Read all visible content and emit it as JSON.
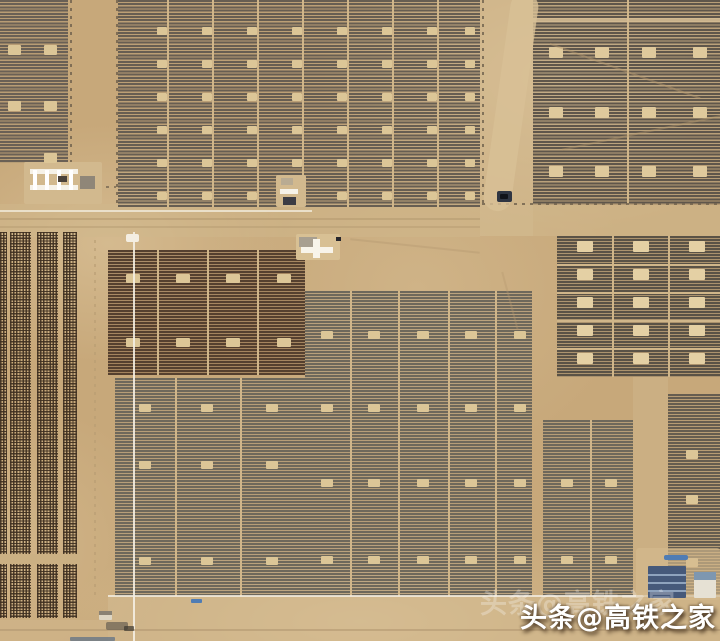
{
  "watermark": {
    "text": "头条@高铁之家"
  },
  "palette": {
    "sand_base": "#c7a87a",
    "sand_light": "#d8c198",
    "sand_road": "#d0b78c",
    "panel_gray": "#675e52",
    "panel_dark_brown": "#55402f",
    "panel_gray_olive": "#6e685b",
    "panel_cellgrid": "#5a5246",
    "marker_beige": "#dcc697",
    "marker_bright": "#e4d0a4",
    "white_line": "#f4eee2",
    "blue_roof": "#7e97b0",
    "blue_vehicle": "#4f7cb4",
    "dark_vehicle": "#2f3542"
  },
  "scene": {
    "divider_color": "#d0b68a",
    "marker_color": "#dcc697",
    "patches": [
      {
        "name": "road-band-sand",
        "x": 0,
        "y": 204,
        "w": 480,
        "h": 33,
        "color": "#d0b78c",
        "opacity": 0.5
      },
      {
        "name": "roadside-sand",
        "x": 480,
        "y": 0,
        "w": 53,
        "h": 236,
        "color": "#d3bb91",
        "opacity": 0.5
      },
      {
        "name": "road-band-right-sand",
        "x": 480,
        "y": 205,
        "w": 240,
        "h": 31,
        "color": "#d2b98e",
        "opacity": 0.5
      },
      {
        "name": "bottom-sand-band",
        "x": 108,
        "y": 597,
        "w": 612,
        "h": 44,
        "color": "#d4bb92",
        "opacity": 0.55
      },
      {
        "name": "bottom-left-sand",
        "x": 0,
        "y": 620,
        "w": 108,
        "h": 21,
        "color": "#d2b88e",
        "opacity": 0.5
      },
      {
        "name": "right-corridor-sand",
        "x": 633,
        "y": 377,
        "w": 35,
        "h": 220,
        "color": "#cfb68c",
        "opacity": 0.5
      }
    ],
    "blocks": [
      {
        "name": "pv-array-top-left",
        "kind": "hstripe",
        "x": 0,
        "y": 0,
        "w": 68,
        "h": 163,
        "dark": "#6a6055",
        "t": 2,
        "pitch": 3.2,
        "tint": "rgba(118,106,90,0.18)",
        "marker": {
          "cols": [
            8,
            44
          ],
          "rows": [
            45,
            101
          ],
          "w": 13,
          "h": 10
        }
      },
      {
        "name": "pv-array-top-middle",
        "kind": "hstripe",
        "x": 118,
        "y": 0,
        "w": 362,
        "h": 207,
        "dark": "#675e52",
        "t": 2,
        "pitch": 3.2,
        "tint": "rgba(120,108,92,0.15)",
        "dividers_v": [
          167,
          212,
          257,
          302,
          347,
          392,
          437
        ],
        "marker": {
          "cols": [
            157,
            202,
            247,
            292,
            337,
            382,
            427,
            465
          ],
          "rows": [
            27,
            60,
            93,
            126,
            159,
            192
          ],
          "w": 10,
          "h": 8
        }
      },
      {
        "name": "pv-array-top-right",
        "kind": "hstripe",
        "x": 533,
        "y": 0,
        "w": 187,
        "h": 205,
        "dark": "#5f564b",
        "t": 2,
        "pitch": 3.2,
        "tint": "rgba(110,98,84,0.2)",
        "dividers_v": [
          627
        ],
        "marker": {
          "cols": [
            549,
            595,
            642,
            693
          ],
          "rows": [
            47,
            107,
            166
          ],
          "w": 14,
          "h": 11,
          "color": "#dfc99c"
        }
      },
      {
        "name": "pv-array-dark-brown",
        "kind": "hstripe",
        "x": 108,
        "y": 250,
        "w": 197,
        "h": 125,
        "dark": "#55402f",
        "t": 2,
        "pitch": 3,
        "tint": "rgba(96,62,40,0.35)",
        "dividers_v": [
          157,
          207,
          257
        ],
        "marker": {
          "cols": [
            126,
            176,
            226,
            277
          ],
          "rows": [
            274,
            338
          ],
          "w": 14,
          "h": 9
        }
      },
      {
        "name": "pv-array-gray-left",
        "kind": "hstripe",
        "x": 115,
        "y": 378,
        "w": 190,
        "h": 218,
        "dark": "#6e685b",
        "t": 1.8,
        "pitch": 3,
        "tint": "rgba(130,124,110,0.25)",
        "dividers_v": [
          175,
          240
        ],
        "marker": {
          "cols": [
            139,
            201,
            266
          ],
          "rows": [
            404,
            461,
            557
          ],
          "w": 12,
          "h": 8
        }
      },
      {
        "name": "pv-array-gray-main",
        "kind": "hstripe",
        "x": 305,
        "y": 291,
        "w": 227,
        "h": 305,
        "dark": "#6e685b",
        "t": 1.8,
        "pitch": 3,
        "tint": "rgba(130,124,110,0.25)",
        "dividers_v": [
          350,
          398,
          448,
          495
        ],
        "marker": {
          "cols": [
            321,
            368,
            417,
            465,
            514
          ],
          "rows": [
            331,
            404,
            479,
            556
          ],
          "w": 12,
          "h": 8
        }
      },
      {
        "name": "pv-array-gray-right",
        "kind": "hstripe",
        "x": 543,
        "y": 420,
        "w": 90,
        "h": 176,
        "dark": "#6e685b",
        "t": 1.8,
        "pitch": 3,
        "tint": "rgba(130,124,110,0.25)",
        "dividers_v": [
          590
        ],
        "marker": {
          "cols": [
            561,
            605
          ],
          "rows": [
            479,
            556
          ],
          "w": 12,
          "h": 8
        }
      },
      {
        "name": "pv-array-cell-grid",
        "kind": "hstripe",
        "x": 557,
        "y": 236,
        "w": 163,
        "h": 141,
        "dark": "#5a5246",
        "t": 2,
        "pitch": 3,
        "tint": "rgba(105,95,80,0.3)",
        "dividers_v": [
          612,
          668
        ],
        "dividers_h": [
          264,
          292,
          320,
          348
        ],
        "marker": {
          "cols": [
            577,
            633,
            689
          ],
          "rows": [
            241,
            269,
            297,
            325,
            353
          ],
          "w": 16,
          "h": 11,
          "color": "#e4d0a4"
        }
      },
      {
        "name": "pv-array-bottom-right",
        "kind": "hstripe",
        "x": 668,
        "y": 394,
        "w": 52,
        "h": 203,
        "dark": "#665d50",
        "t": 2,
        "pitch": 3,
        "tint": "rgba(120,110,95,0.2)",
        "marker": {
          "cols": [
            686
          ],
          "rows": [
            450,
            495,
            558
          ],
          "w": 12,
          "h": 9
        }
      },
      {
        "name": "tracker-dot-strip",
        "kind": "dots",
        "x": 0,
        "y": 232,
        "w": 7,
        "h": 386,
        "dark": "rgba(62,47,32,0.9)"
      },
      {
        "name": "tracker-dot-strip",
        "kind": "dots",
        "x": 10,
        "y": 232,
        "w": 21,
        "h": 386,
        "dark": "rgba(62,47,32,0.9)"
      },
      {
        "name": "tracker-dot-strip",
        "kind": "dots",
        "x": 37,
        "y": 232,
        "w": 21,
        "h": 386,
        "dark": "rgba(62,47,32,0.9)"
      },
      {
        "name": "tracker-dot-strip",
        "kind": "dots",
        "x": 63,
        "y": 232,
        "w": 14,
        "h": 386,
        "dark": "rgba(62,47,32,0.9)"
      }
    ],
    "lines": [
      {
        "name": "fence-line",
        "kind": "dash-v",
        "x": 70,
        "y": 0,
        "w": 1.5,
        "h": 163,
        "color": "#6e604c",
        "opacity": 0.8
      },
      {
        "name": "fence-line",
        "kind": "dash-v",
        "x": 116,
        "y": 0,
        "w": 1.5,
        "h": 206,
        "color": "#6e604c",
        "opacity": 0.8
      },
      {
        "name": "fence-line",
        "kind": "dash-v",
        "x": 482,
        "y": 0,
        "w": 1.5,
        "h": 204,
        "color": "#6e604c",
        "opacity": 0.8
      },
      {
        "name": "fence-line",
        "kind": "dash-h",
        "x": 482,
        "y": 203,
        "w": 238,
        "h": 1.5,
        "color": "#6e604c",
        "opacity": 0.8
      },
      {
        "name": "fence-line",
        "kind": "dash-h",
        "x": 58,
        "y": 186,
        "w": 58,
        "h": 1.5,
        "color": "#6e604c",
        "opacity": 0.7
      },
      {
        "name": "road-white-line",
        "kind": "solid",
        "x": 0,
        "y": 210,
        "w": 312,
        "h": 2,
        "color": "#efe7d6",
        "opacity": 0.85
      },
      {
        "name": "tire-track",
        "kind": "solid",
        "x": 0,
        "y": 218,
        "w": 480,
        "h": 1.5,
        "color": "#b59b72",
        "opacity": 0.6
      },
      {
        "name": "tire-track",
        "kind": "solid",
        "x": 0,
        "y": 226,
        "w": 480,
        "h": 1.5,
        "color": "#b59b72",
        "opacity": 0.5
      },
      {
        "name": "utility-line",
        "kind": "solid",
        "x": 133,
        "y": 232,
        "w": 2,
        "h": 409,
        "color": "#f4eee2",
        "opacity": 0.9
      },
      {
        "name": "panel-edge-white-line",
        "kind": "solid",
        "x": 108,
        "y": 595,
        "w": 612,
        "h": 2,
        "color": "#f2ecdf",
        "opacity": 0.85
      },
      {
        "name": "bottom-road-line",
        "kind": "solid",
        "x": 0,
        "y": 629,
        "w": 720,
        "h": 2,
        "color": "#b39872",
        "opacity": 0.6
      },
      {
        "name": "panel-gap-line",
        "kind": "solid",
        "x": 533,
        "y": 18,
        "w": 187,
        "h": 4,
        "color": "#d5bd93",
        "opacity": 0.9
      },
      {
        "name": "corridor-track",
        "kind": "dash-v",
        "x": 94,
        "y": 240,
        "w": 1.5,
        "h": 360,
        "color": "#b79c72",
        "opacity": 0.6
      },
      {
        "name": "dot-array-gap",
        "kind": "solid",
        "x": 0,
        "y": 554,
        "w": 80,
        "h": 10,
        "color": "#cbb083",
        "opacity": 1
      }
    ],
    "structures": [
      {
        "name": "dirt-track-winding",
        "x": 497,
        "y": -8,
        "w": 28,
        "h": 220,
        "color": "#d8c096",
        "r": 14,
        "opacity": 0.8,
        "rotate": 8
      },
      {
        "name": "sand-crack",
        "x": 545,
        "y": 70,
        "w": 160,
        "h": 2,
        "color": "#b69a6e",
        "opacity": 0.45,
        "rotate": 20
      },
      {
        "name": "sand-crack",
        "x": 560,
        "y": 130,
        "w": 180,
        "h": 2,
        "color": "#b69a6e",
        "opacity": 0.4,
        "rotate": -12
      },
      {
        "name": "sand-crack",
        "x": 350,
        "y": 245,
        "w": 130,
        "h": 2,
        "color": "#b49870",
        "opacity": 0.4,
        "rotate": 6
      },
      {
        "name": "sand-crack",
        "x": 480,
        "y": 300,
        "w": 60,
        "h": 2,
        "color": "#b49870",
        "opacity": 0.35,
        "rotate": 75
      },
      {
        "name": "substation-pad",
        "x": 24,
        "y": 162,
        "w": 78,
        "h": 42,
        "color": "#d2b98e",
        "r": 2
      },
      {
        "name": "substation-gantry-bar",
        "x": 30,
        "y": 169,
        "w": 48,
        "h": 5,
        "color": "#f6f2e8"
      },
      {
        "name": "substation-gantry-bar",
        "x": 30,
        "y": 185,
        "w": 48,
        "h": 5,
        "color": "#f6f2e8"
      },
      {
        "name": "substation-post",
        "x": 33,
        "y": 170,
        "w": 4,
        "h": 20,
        "color": "#ffffff"
      },
      {
        "name": "substation-post",
        "x": 45,
        "y": 170,
        "w": 4,
        "h": 20,
        "color": "#ffffff"
      },
      {
        "name": "substation-post",
        "x": 57,
        "y": 170,
        "w": 4,
        "h": 20,
        "color": "#ffffff"
      },
      {
        "name": "substation-post",
        "x": 69,
        "y": 170,
        "w": 4,
        "h": 20,
        "color": "#ffffff"
      },
      {
        "name": "substation-box",
        "x": 80,
        "y": 176,
        "w": 15,
        "h": 13,
        "color": "#8f8678"
      },
      {
        "name": "substation-dark-unit",
        "x": 58,
        "y": 176,
        "w": 9,
        "h": 6,
        "color": "#4a423a"
      },
      {
        "name": "inverter-station-pad",
        "x": 276,
        "y": 175,
        "w": 30,
        "h": 32,
        "color": "#d2b98e",
        "r": 2
      },
      {
        "name": "inverter-station-box",
        "x": 281,
        "y": 178,
        "w": 12,
        "h": 7,
        "color": "#b9ab92"
      },
      {
        "name": "inverter-station-bar",
        "x": 280,
        "y": 189,
        "w": 18,
        "h": 5,
        "color": "#f6f2e8"
      },
      {
        "name": "inverter-station-dark-unit",
        "x": 283,
        "y": 197,
        "w": 13,
        "h": 8,
        "color": "#3c3c44"
      },
      {
        "name": "switchyard-pad",
        "x": 296,
        "y": 234,
        "w": 44,
        "h": 26,
        "color": "#d8c094",
        "r": 2
      },
      {
        "name": "switchyard-building",
        "x": 299,
        "y": 237,
        "w": 18,
        "h": 10,
        "color": "#a89f90"
      },
      {
        "name": "switchyard-cross-h",
        "x": 301,
        "y": 247,
        "w": 32,
        "h": 6,
        "color": "#f8f4ea"
      },
      {
        "name": "switchyard-cross-v",
        "x": 313,
        "y": 239,
        "w": 7,
        "h": 19,
        "color": "#f8f4ea"
      },
      {
        "name": "switchyard-dark-dot",
        "x": 336,
        "y": 237,
        "w": 5,
        "h": 4,
        "color": "#26262c"
      },
      {
        "name": "pole-white-mark",
        "x": 126,
        "y": 234,
        "w": 13,
        "h": 8,
        "color": "#f4eee2",
        "r": 2
      },
      {
        "name": "vehicle-dark",
        "x": 497,
        "y": 191,
        "w": 15,
        "h": 11,
        "color": "#2f3542",
        "r": 2
      },
      {
        "name": "vehicle-dark-cab",
        "x": 500,
        "y": 194,
        "w": 8,
        "h": 5,
        "color": "#11131a",
        "r": 1
      },
      {
        "name": "compound-pad",
        "x": 636,
        "y": 548,
        "w": 84,
        "h": 52,
        "color": "#d4ba8e",
        "r": 3,
        "opacity": 0.65
      },
      {
        "name": "pv-shed-blue",
        "x": 648,
        "y": 566,
        "w": 38,
        "h": 32,
        "color": "#46597a",
        "r": 1
      },
      {
        "name": "pv-shed-stripe",
        "x": 648,
        "y": 574,
        "w": 38,
        "h": 1.5,
        "color": "#8fa3bd"
      },
      {
        "name": "pv-shed-stripe",
        "x": 648,
        "y": 582,
        "w": 38,
        "h": 1.5,
        "color": "#8fa3bd"
      },
      {
        "name": "pv-shed-stripe",
        "x": 648,
        "y": 590,
        "w": 38,
        "h": 1.5,
        "color": "#8fa3bd"
      },
      {
        "name": "building-white",
        "x": 694,
        "y": 572,
        "w": 22,
        "h": 26,
        "color": "#e6e1d4",
        "r": 1
      },
      {
        "name": "building-blue-roof",
        "x": 694,
        "y": 572,
        "w": 22,
        "h": 8,
        "color": "#7e97b0"
      },
      {
        "name": "vehicle-blue",
        "x": 664,
        "y": 555,
        "w": 24,
        "h": 5,
        "color": "#4f7cb4",
        "r": 2
      },
      {
        "name": "vehicle-blue",
        "x": 191,
        "y": 599,
        "w": 11,
        "h": 4,
        "color": "#4f7cb4",
        "r": 1
      },
      {
        "name": "hut-white",
        "x": 99,
        "y": 611,
        "w": 13,
        "h": 9,
        "color": "#ded6c4",
        "r": 1
      },
      {
        "name": "hut-roof",
        "x": 99,
        "y": 611,
        "w": 13,
        "h": 4,
        "color": "#8a8274"
      },
      {
        "name": "ground-debris",
        "x": 106,
        "y": 622,
        "w": 22,
        "h": 8,
        "color": "#57524a",
        "r": 2,
        "opacity": 0.6
      },
      {
        "name": "ground-debris",
        "x": 124,
        "y": 626,
        "w": 10,
        "h": 5,
        "color": "#3c3830",
        "r": 1,
        "opacity": 0.7
      },
      {
        "name": "blue-edge-strip",
        "x": 70,
        "y": 637,
        "w": 45,
        "h": 4,
        "color": "#5a6e86",
        "r": 1,
        "opacity": 0.7
      },
      {
        "name": "inverter-box",
        "x": 44,
        "y": 153,
        "w": 13,
        "h": 10,
        "color": "#dcc697",
        "r": 1
      }
    ]
  }
}
